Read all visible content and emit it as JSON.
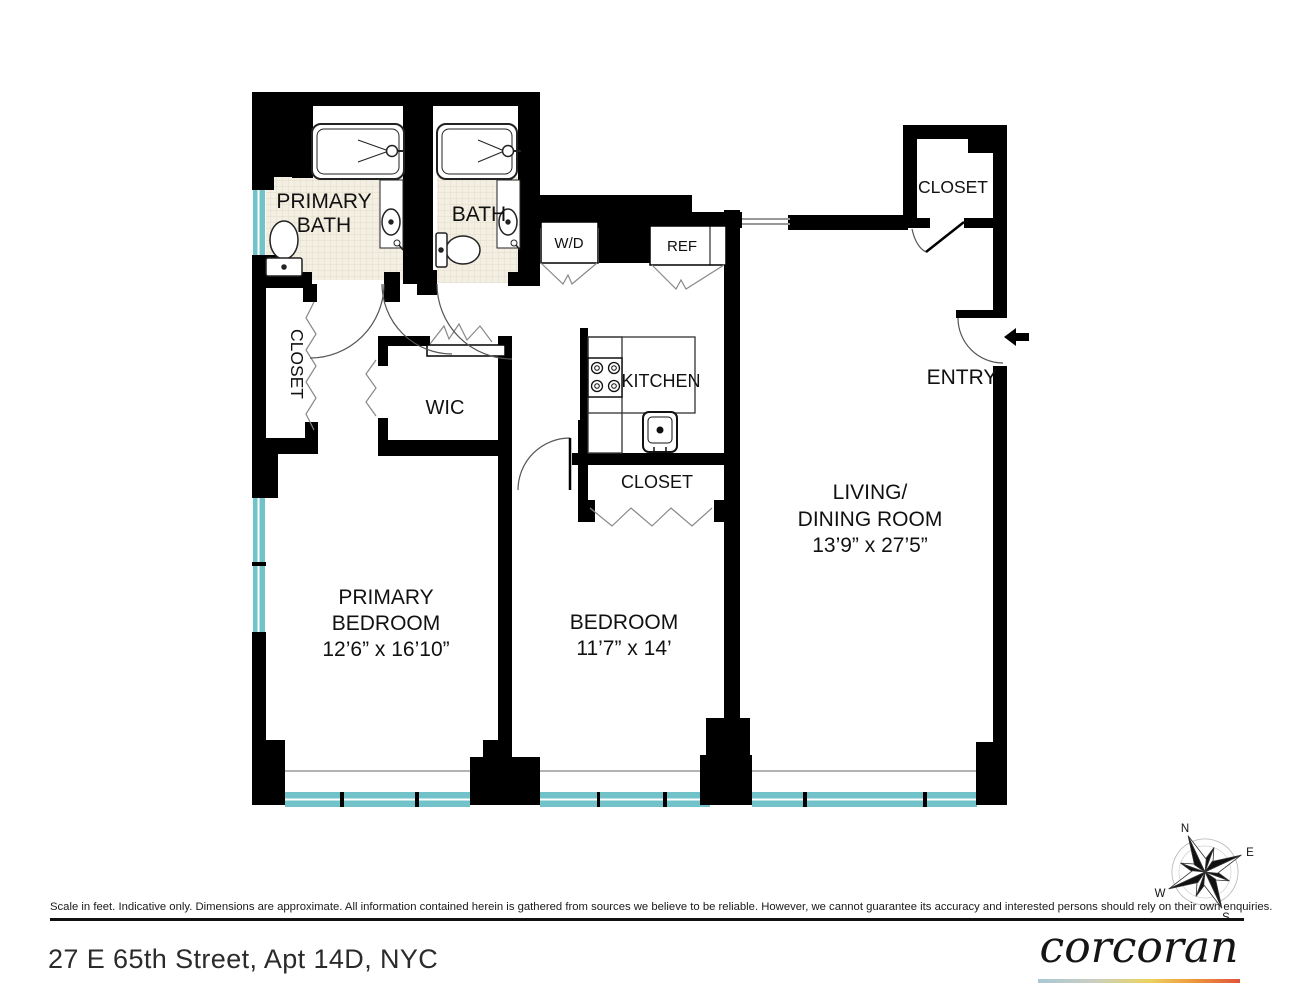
{
  "plan": {
    "rooms": {
      "primary_bath": {
        "line1": "PRIMARY",
        "line2": "BATH"
      },
      "bath": "BATH",
      "wd": "W/D",
      "ref": "REF",
      "entry_closet": "CLOSET",
      "entry": "ENTRY",
      "kitchen": "KITCHEN",
      "kitchen_closet": "CLOSET",
      "hall_closet": "CLOSET",
      "wic": "WIC",
      "living": {
        "line1": "LIVING/",
        "line2": "DINING ROOM",
        "dims": "13’9” x 27’5”"
      },
      "primary_bedroom": {
        "line1": "PRIMARY",
        "line2": "BEDROOM",
        "dims": "12’6” x 16’10”"
      },
      "bedroom": {
        "line1": "BEDROOM",
        "dims": "11’7” x 14’"
      }
    },
    "compass": {
      "n": "N",
      "e": "E",
      "s": "S",
      "w": "W"
    }
  },
  "footer": {
    "disclaimer": "Scale in feet. Indicative only. Dimensions are approximate. All information contained herein is gathered from sources we believe to be reliable. However, we cannot guarantee its accuracy and interested persons should rely on their own enquiries.",
    "address": "27 E 65th Street, Apt 14D, NYC",
    "brand": "corcoran"
  },
  "colors": {
    "wall": "#000000",
    "window": "#72c3c9",
    "tile_floor": "#f3efe2",
    "logo_gradient_1": "#a9c7d6",
    "logo_gradient_2": "#c9cfc0",
    "logo_gradient_3": "#ecd35f",
    "logo_gradient_4": "#ee9d3d",
    "logo_gradient_5": "#e2533b"
  }
}
